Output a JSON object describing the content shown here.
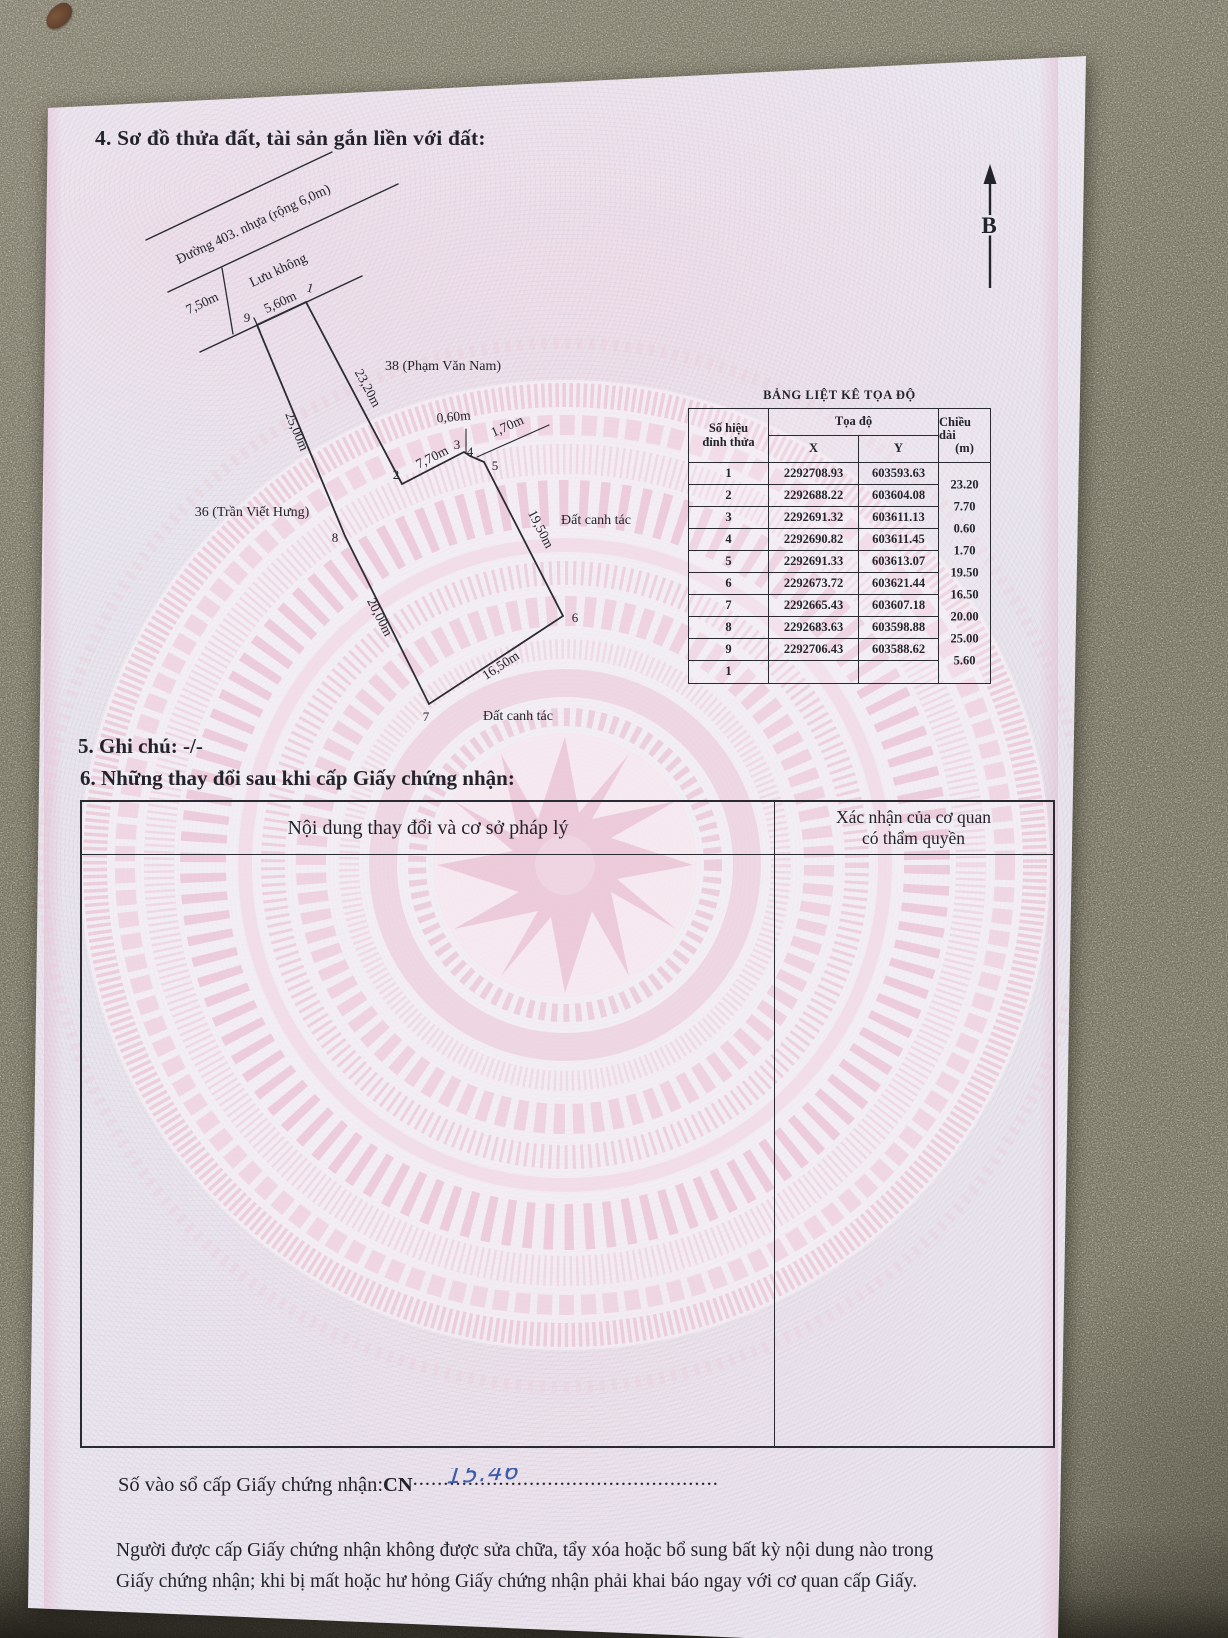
{
  "colors": {
    "paper": "#eae6ee",
    "ink": "#23232c",
    "watermark_pink": "#ecc9d6",
    "handwriting_blue": "#3c5ba8",
    "granite": "#8e8a7a"
  },
  "document": {
    "section4_title": "4. Sơ đồ thửa đất, tài sản gắn liền với đất:",
    "section5_title": "5. Ghi chú: -/-",
    "section6_title": "6. Những thay đổi sau khi cấp Giấy chứng nhận:"
  },
  "diagram": {
    "north_label": "B",
    "road_name": "Đường 403. nhựa (rộng 6,0m)",
    "buffer_zone": "Lưu không",
    "neighbor_left": "36 (Trần Viết Hưng)",
    "neighbor_right": "38 (Phạm Văn Nam)",
    "land_right": "Đất canh tác",
    "land_bottom": "Đất canh tác",
    "dims": {
      "setback": "7,50m",
      "front": "5,60m",
      "e12": "23,20m",
      "e23": "7,70m",
      "e34": "0,60m",
      "e45": "1,70m",
      "e56": "19,50m",
      "e67": "16,50m",
      "e78": "20,00m",
      "e89": "25,00m"
    },
    "vertices": {
      "v1": "1",
      "v2": "2",
      "v3": "3",
      "v4": "4",
      "v5": "5",
      "v6": "6",
      "v7": "7",
      "v8": "8",
      "v9": "9"
    }
  },
  "coord_table": {
    "title": "BẢNG LIỆT KÊ TỌA ĐỘ",
    "header": {
      "id1": "Số hiệu",
      "id2": "đỉnh thửa",
      "coords": "Tọa độ",
      "x": "X",
      "y": "Y",
      "len1": "Chiều dài",
      "len2": "(m)"
    },
    "rows": [
      {
        "id": "1",
        "x": "2292708.93",
        "y": "603593.63"
      },
      {
        "id": "2",
        "x": "2292688.22",
        "y": "603604.08"
      },
      {
        "id": "3",
        "x": "2292691.32",
        "y": "603611.13"
      },
      {
        "id": "4",
        "x": "2292690.82",
        "y": "603611.45"
      },
      {
        "id": "5",
        "x": "2292691.33",
        "y": "603613.07"
      },
      {
        "id": "6",
        "x": "2292673.72",
        "y": "603621.44"
      },
      {
        "id": "7",
        "x": "2292665.43",
        "y": "603607.18"
      },
      {
        "id": "8",
        "x": "2292683.63",
        "y": "603598.88"
      },
      {
        "id": "9",
        "x": "2292706.43",
        "y": "603588.62"
      },
      {
        "id": "1",
        "x": "",
        "y": ""
      }
    ],
    "lengths": [
      "23.20",
      "7.70",
      "0.60",
      "1.70",
      "19.50",
      "16.50",
      "20.00",
      "25.00",
      "5.60"
    ]
  },
  "changes_table": {
    "left_header": "Nội dung thay đổi và cơ sở pháp lý",
    "right_header_line1": "Xác nhận của cơ quan",
    "right_header_line2": "có thẩm quyền"
  },
  "footer": {
    "register_label": "Số vào sổ cấp Giấy chứng nhận:",
    "register_prefix": "CN",
    "register_dots": "..................................................",
    "register_number": "15.46",
    "note_line1": "Người được cấp Giấy chứng nhận không được sửa chữa, tẩy xóa hoặc bổ sung bất kỳ nội dung nào trong",
    "note_line2": "Giấy chứng nhận; khi bị mất hoặc hư hỏng Giấy chứng nhận phải khai báo ngay với cơ quan cấp Giấy."
  }
}
